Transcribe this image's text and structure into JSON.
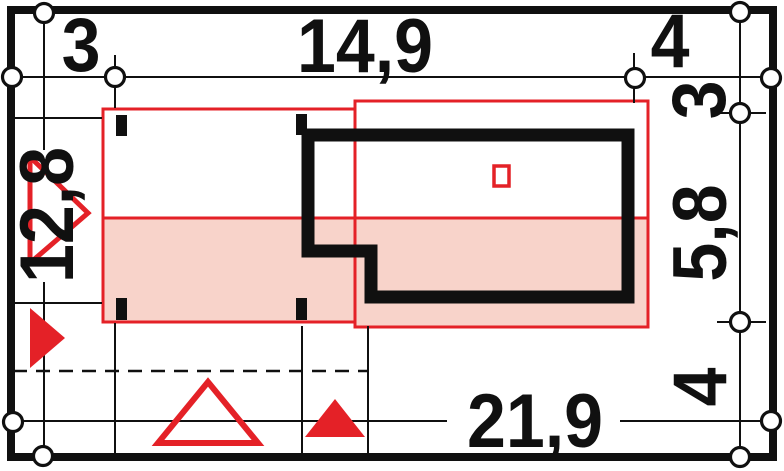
{
  "drawing_title": "plot-site-plan",
  "colors": {
    "ink": "#101010",
    "red": "#e42127",
    "pink": "#f8d3ca"
  },
  "dimensions": {
    "top": [
      {
        "label": "3"
      },
      {
        "label": "14,9"
      },
      {
        "label": "4"
      }
    ],
    "right": [
      {
        "label": "3"
      },
      {
        "label": "5,8"
      },
      {
        "label": "4"
      }
    ],
    "left": [
      {
        "label": "12,8"
      }
    ],
    "bottom": [
      {
        "label": "21,9"
      }
    ]
  }
}
